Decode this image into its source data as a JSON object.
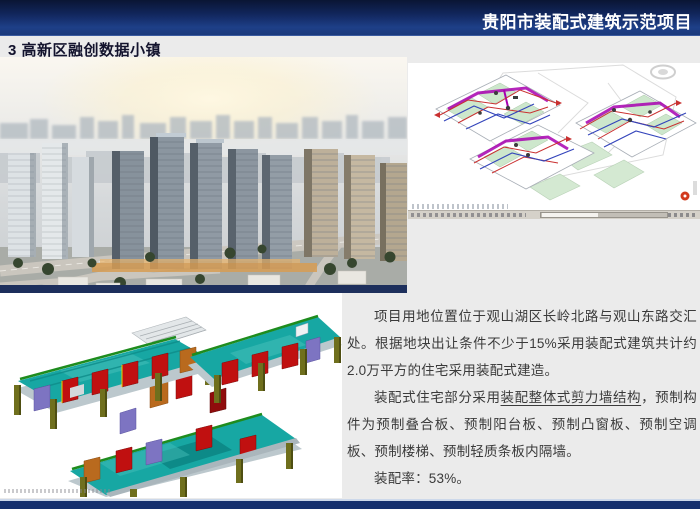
{
  "header": {
    "project_title": "贵阳市装配式建筑示范项目"
  },
  "section_title": "3 高新区融创数据小镇",
  "description": {
    "para1": "项目用地位置位于观山湖区长岭北路与观山东路交汇处。根据地块出让条件不少于15%采用装配式建筑共计约2.0万平方的住宅采用装配式建造。",
    "para2_prefix": "装配式住宅部分采用",
    "para2_underlined": "装配整体式剪力墙结构",
    "para2_suffix": "，预制构件为预制叠合板、预制阳台板、预制凸窗板、预制空调板、预制楼梯、预制轻质条板内隔墙。",
    "para3": "装配率：53%。"
  },
  "icons": {
    "steering_wheel": "steering-wheel-icon",
    "warning_badge": "warning-badge-icon"
  },
  "colors": {
    "header_navy_top": "#0a1534",
    "header_navy_bottom": "#1e3f88",
    "footer_navy": "#15306e",
    "title_text": "#13132d",
    "body_text": "#3a3a3a",
    "model_teal": "#17a7a3",
    "model_red": "#c01010",
    "model_olive": "#6f6f1d",
    "model_purple": "#7d74c2",
    "model_orange": "#b96a1e",
    "pipe_magenta": "#a800b0",
    "pipe_red": "#c93030",
    "pipe_blue": "#3344bb",
    "room_green": "#cde7cc",
    "badge_red": "#d23a1e"
  }
}
